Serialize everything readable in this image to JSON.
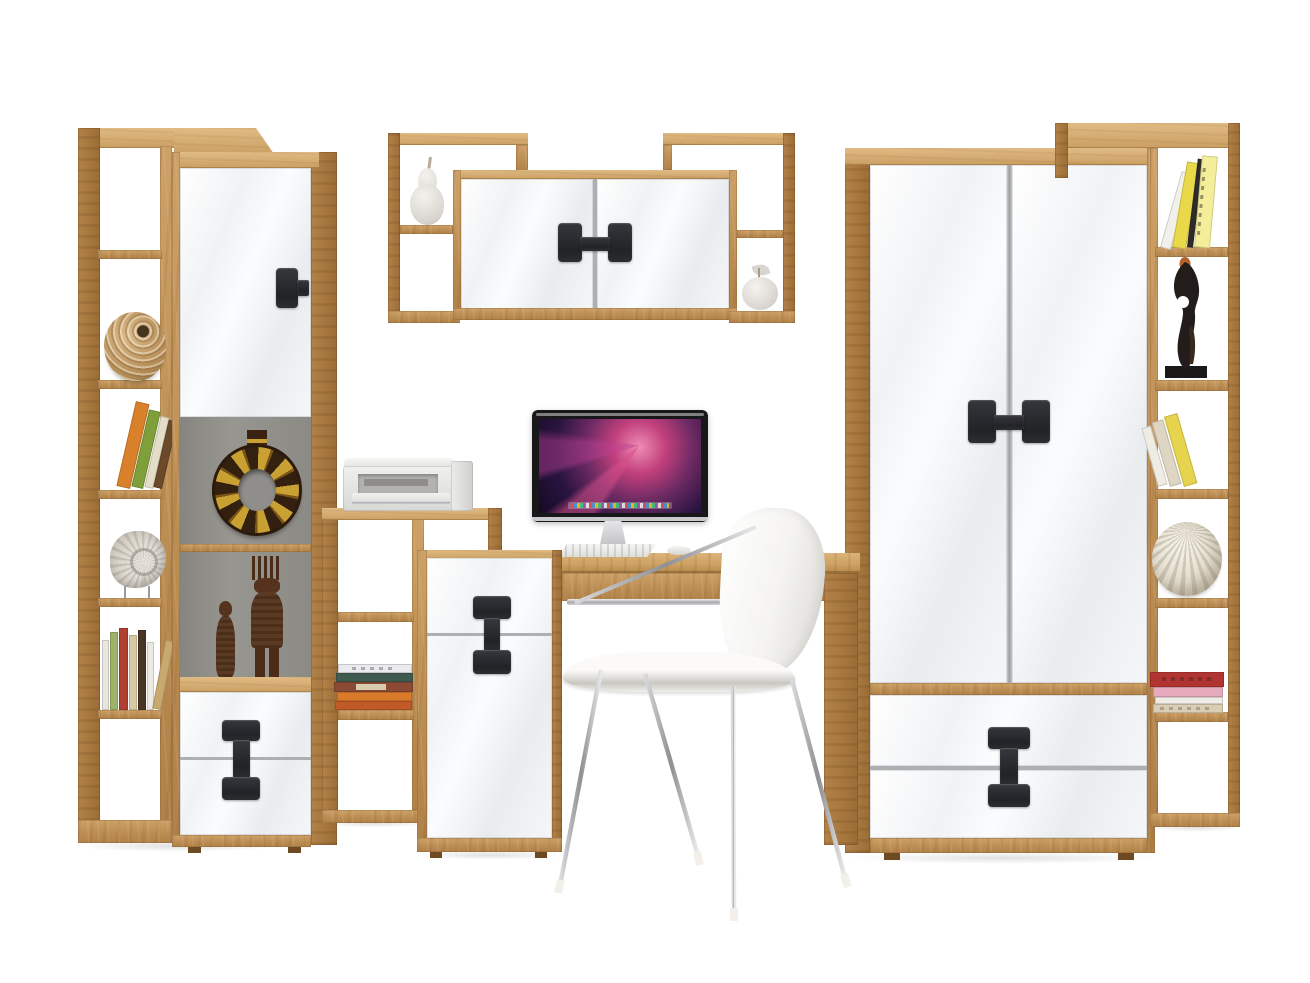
{
  "scene": {
    "kind": "furniture-product-photo",
    "title": "Teen room wall unit set: bookcases, display cabinet, wall shelf, desk with cabinet, wardrobe and chair",
    "background": "#ffffff",
    "width": 1310,
    "height": 983
  },
  "palette": {
    "wood": "#bd8e53",
    "wood_light": "#dcb57c",
    "wood_dark": "#9b6d36",
    "front_white": "#f4f6f7",
    "handle_black": "#28292b",
    "niche_gray": "#8f8e8a",
    "chrome": "#b9babc",
    "screen_purple": "#2a1440",
    "screen_pink": "#d94f8c"
  },
  "furniture": {
    "left_bookcase": {
      "title": "Tall open bookcase (artisan oak)",
      "decor": [
        "wicker ball vase",
        "orange and green books",
        "nautilus shell on stand",
        "row of books"
      ]
    },
    "display_cabinet": {
      "title": "Display cabinet with gloss white door and two drawers",
      "decor": [
        "ethnic ring vase",
        "two carved wooden figurines"
      ]
    },
    "wall_shelf": {
      "title": "Wall shelf with two gloss white doors",
      "decor": [
        "white ceramic pear",
        "white ceramic apple"
      ]
    },
    "stepped_shelf": {
      "title": "Low stepped open shelf",
      "decor": [
        "inkjet printer",
        "stack of five books"
      ]
    },
    "desk_cabinet": {
      "title": "Desk container with gloss white drawer and door"
    },
    "desk": {
      "title": "Writing desk (artisan oak)",
      "items": [
        "iMac computer",
        "white keyboard",
        "white mouse"
      ]
    },
    "wardrobe": {
      "title": "Two-door gloss white wardrobe with two drawers"
    },
    "right_bookcase": {
      "title": "Tall open bookcase (artisan oak)",
      "decor": [
        "yellow and white books",
        "black abstract figurine",
        "leaning books",
        "white carved sphere",
        "stack of red, pink and beige books"
      ]
    },
    "chair": {
      "title": "White shell chair with chrome legs"
    }
  },
  "computer": {
    "wallpaper": "purple-pink galaxy",
    "dock_visible": true
  },
  "handles": {
    "door_handle": "black T-block",
    "double_door_handle": "black H-block pair",
    "drawer_handle": "black I-dumbbell spanning two fronts"
  }
}
